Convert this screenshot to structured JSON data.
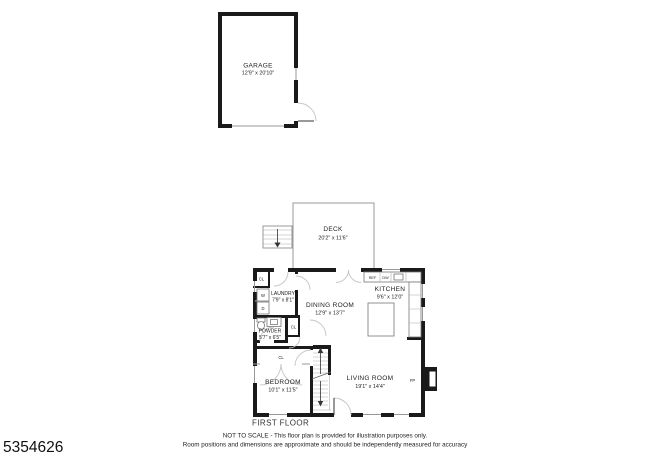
{
  "listing_id": "5354626",
  "floor_label": "FIRST FLOOR",
  "disclaimer": {
    "line1": "NOT TO SCALE - This floor plan is provided for illustration purposes only.",
    "line2": "Room positions and dimensions are approximate and should be independently measured for accuracy"
  },
  "garage": {
    "name": "GARAGE",
    "dims": "12'9\" x 20'10\""
  },
  "deck": {
    "name": "DECK",
    "dims": "20'2\" x 11'6\""
  },
  "rooms": {
    "laundry": {
      "name": "LAUNDRY",
      "dims": "7'9\" x 8'1\""
    },
    "dining_room": {
      "name": "DINING ROOM",
      "dims": "12'9\" x 13'7\""
    },
    "kitchen": {
      "name": "KITCHEN",
      "dims": "9'6\" x 12'0\""
    },
    "powder": {
      "name": "POWDER",
      "dims": "5'7\" x 6'5\""
    },
    "bedroom": {
      "name": "BEDROOM",
      "dims": "10'1\" x 11'5\""
    },
    "living_room": {
      "name": "LIVING ROOM",
      "dims": "19'1\" x 14'4\""
    }
  },
  "labels": {
    "closet": "CL",
    "washer": "W",
    "dryer": "D",
    "refrigerator": "REF",
    "dishwasher": "DW",
    "fireplace": "FP"
  },
  "colors": {
    "wall": "#1a1a1a",
    "thin_line": "#999999",
    "door_arc": "#c4c4c4",
    "text": "#222222"
  }
}
